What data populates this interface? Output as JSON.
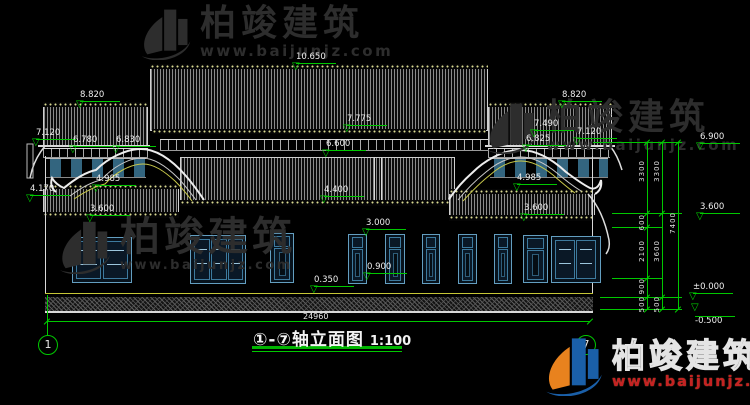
{
  "wm": {
    "brand": "柏竣建筑",
    "url": "www.baijunjz.com"
  },
  "title": {
    "axes": "①-⑦",
    "name": "轴立面图",
    "scale": "1:100"
  },
  "bubbles": {
    "left": "1",
    "right": "7"
  },
  "dims": {
    "overall": "24960"
  },
  "elevations": [
    "10.650",
    "8.820",
    "7.120",
    "6.780",
    "6.830",
    "4.985",
    "4.170",
    "3.600",
    "7.775",
    "6.600",
    "4.400",
    "3.000",
    "0.900",
    "0.350",
    "8.820",
    "7.490",
    "7.120",
    "6.825",
    "4.985",
    "3.600",
    "6.900",
    "3.600",
    "±0.000",
    "-0.500"
  ],
  "vdims": [
    "3300",
    "600",
    "2100",
    "900",
    "500",
    "3300",
    "3600",
    "500",
    "7400"
  ],
  "colors": {
    "dim_green": "#00c800",
    "tile_yellow": "#c6c636",
    "frame_blue": "#639ec0",
    "wm_red": "#c42222"
  }
}
